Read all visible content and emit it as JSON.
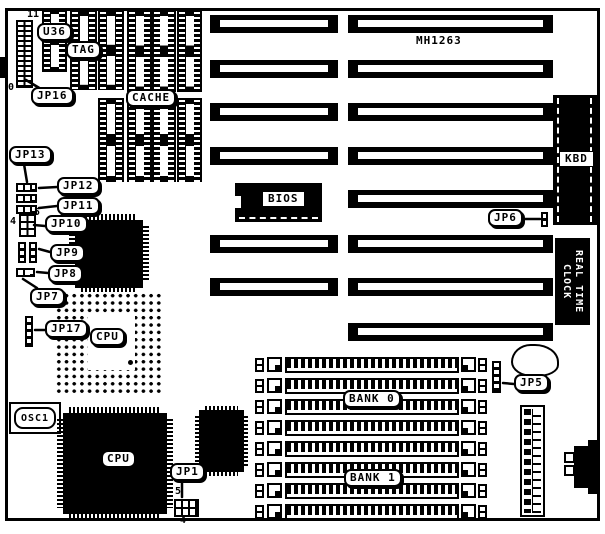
{
  "board": {
    "chip_label": "MH1263",
    "labels": {
      "u36": "U36",
      "tag": "TAG",
      "cache": "CACHE",
      "bios": "BIOS",
      "kbd": "KBD",
      "rtc_line1": "REAL TIME",
      "rtc_line2": "CLOCK",
      "osc1": "OSC1",
      "cpu_socket": "CPU",
      "cpu_chip": "CPU",
      "bank0": "BANK 0",
      "bank1": "BANK 1"
    },
    "jumpers": {
      "jp1": "JP1",
      "jp5": "JP5",
      "jp6": "JP6",
      "jp7": "JP7",
      "jp8": "JP8",
      "jp9": "JP9",
      "jp10": "JP10",
      "jp11": "JP11",
      "jp12": "JP12",
      "jp13": "JP13",
      "jp16": "JP16",
      "jp17": "JP17"
    },
    "pin_numbers": {
      "jp16_top": "11",
      "jp16_bottom": "0",
      "jp10_left": "4",
      "jp10_right": "5",
      "jp1_top": "5",
      "jp1_bottom": "4"
    },
    "colors": {
      "ink": "#000000",
      "background": "#ffffff"
    }
  }
}
